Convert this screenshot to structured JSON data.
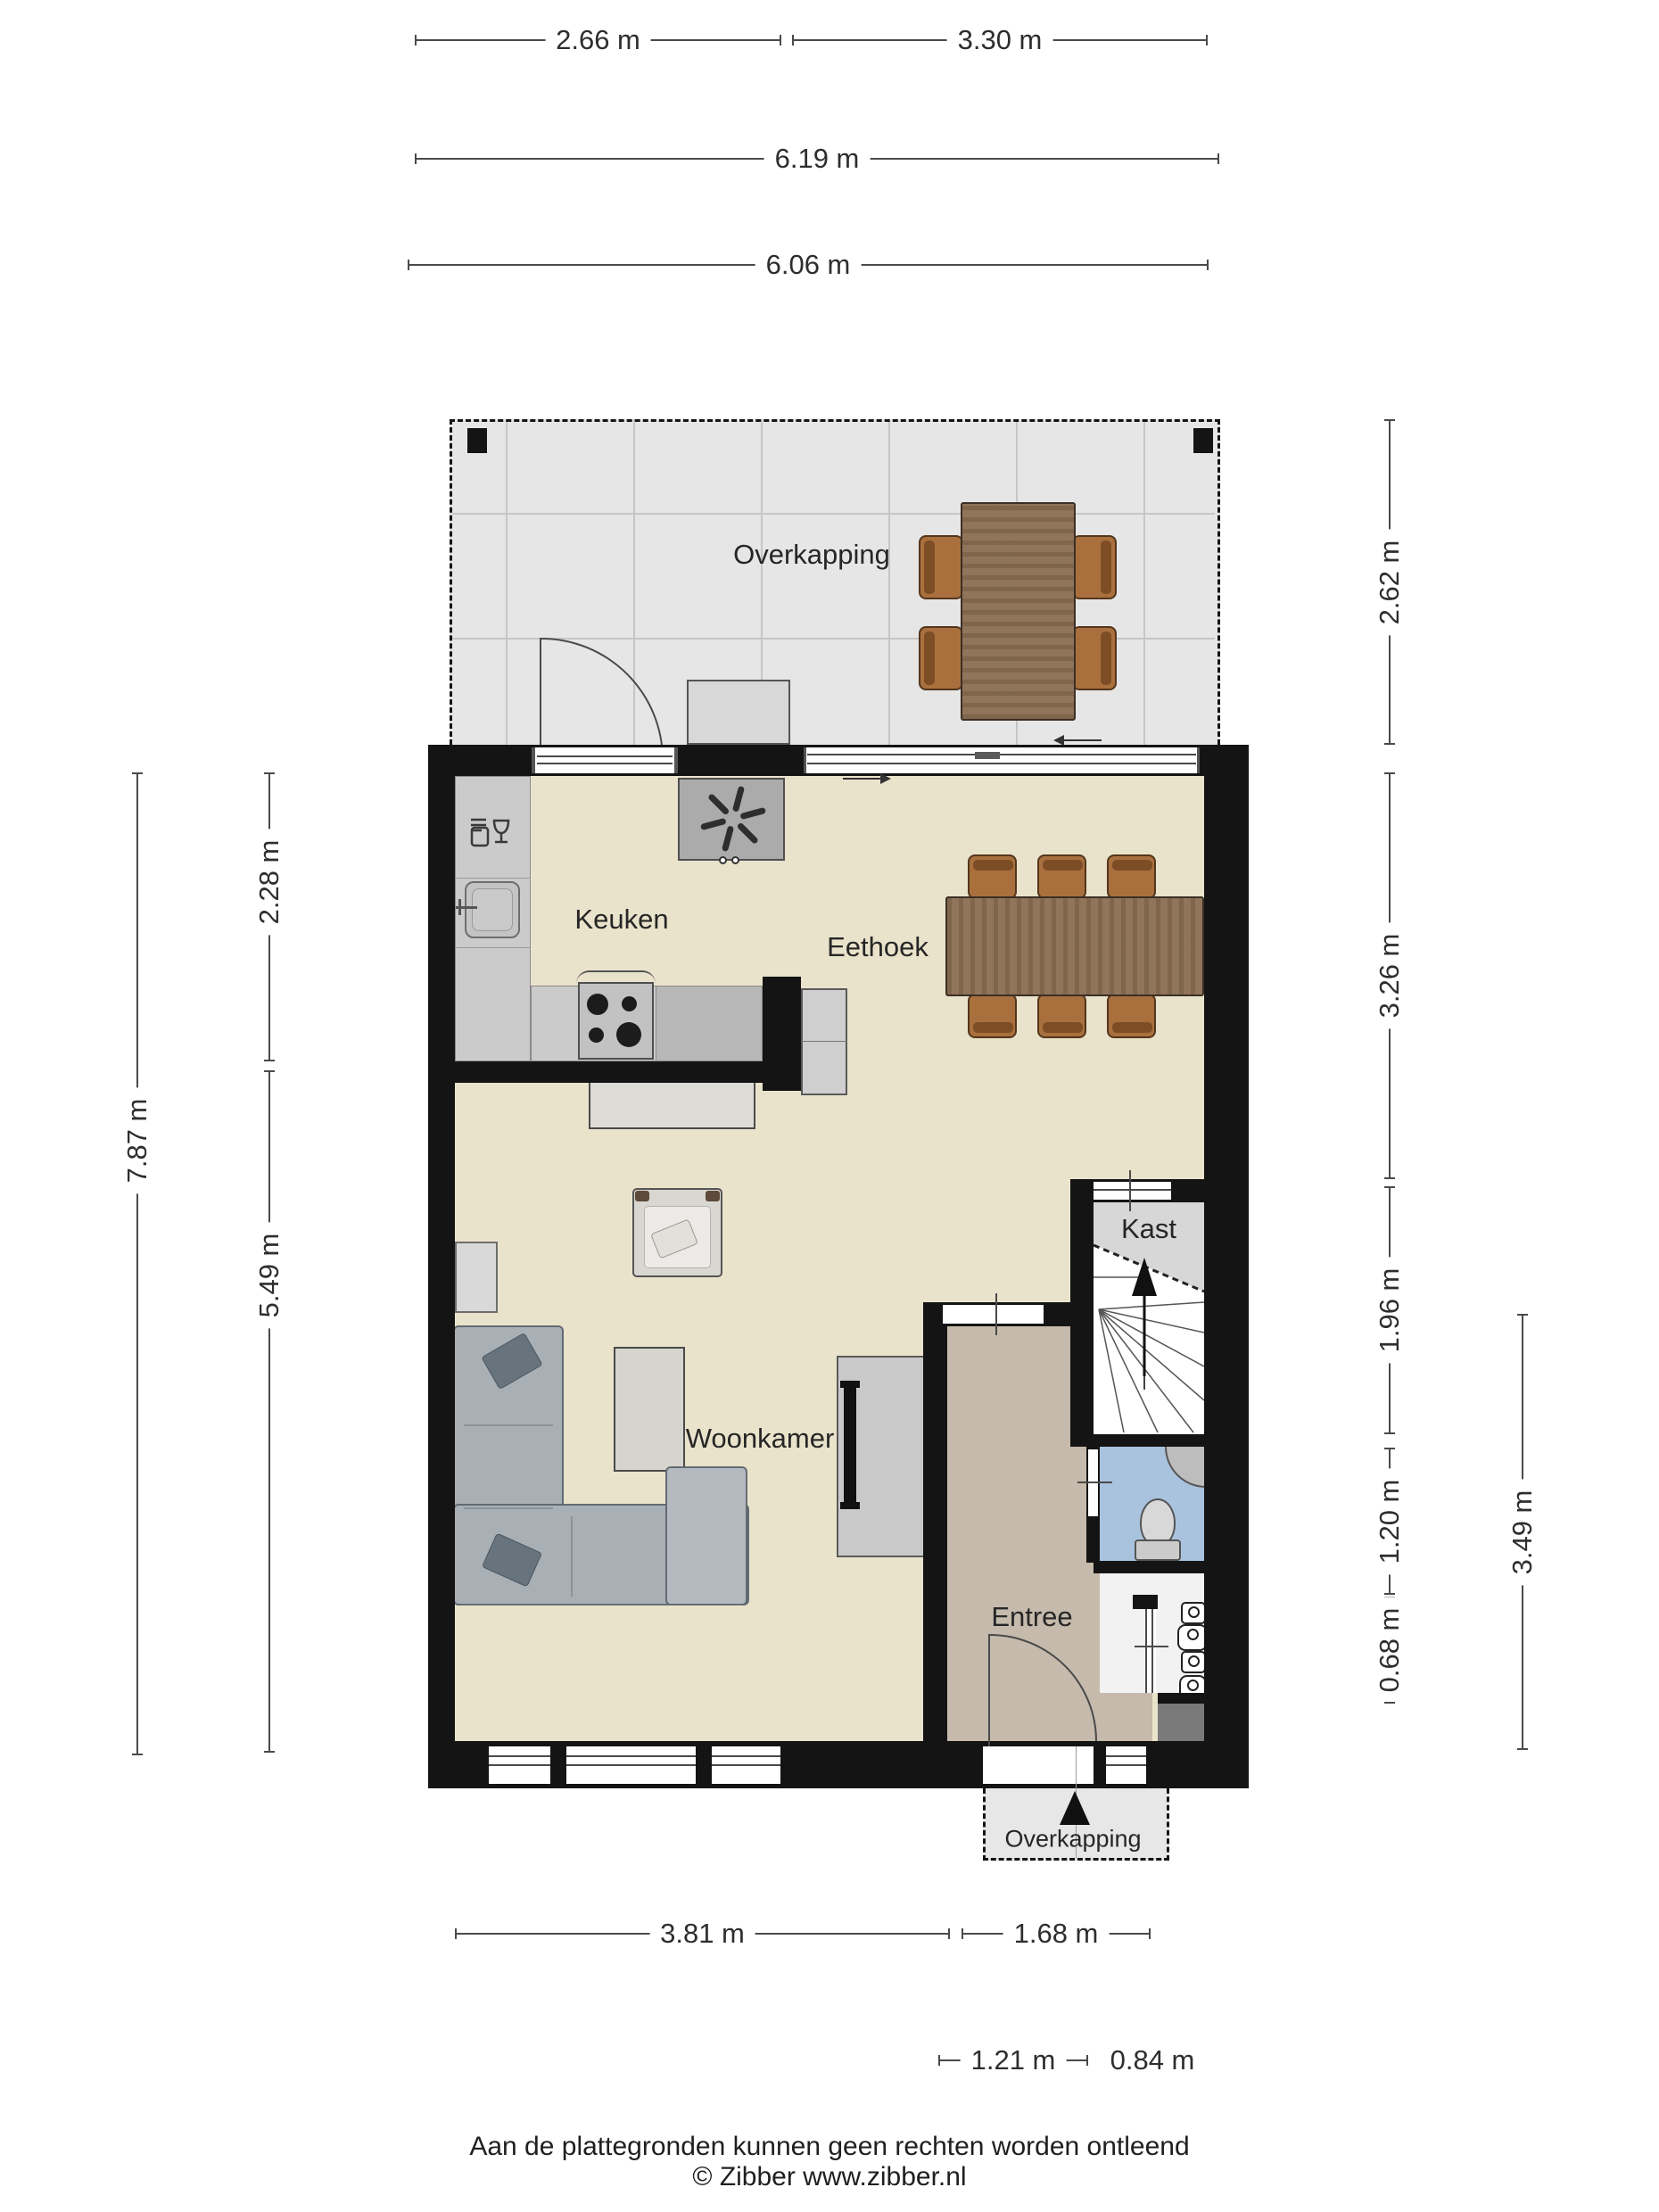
{
  "document": {
    "type": "floor-plan",
    "publisher": "Zibber",
    "language": "nl"
  },
  "rooms": [
    {
      "id": "overkapping-top",
      "label": "Overkapping"
    },
    {
      "id": "keuken",
      "label": "Keuken"
    },
    {
      "id": "eethoek",
      "label": "Eethoek"
    },
    {
      "id": "kast",
      "label": "Kast"
    },
    {
      "id": "woonkamer",
      "label": "Woonkamer"
    },
    {
      "id": "entree",
      "label": "Entree"
    },
    {
      "id": "overkapping-bottom",
      "label": "Overkapping"
    }
  ],
  "dims": [
    {
      "id": "top-overkapping-left",
      "label": "2.66 m"
    },
    {
      "id": "top-overkapping-right",
      "label": "3.30 m"
    },
    {
      "id": "top-overkapping-total",
      "label": "6.19 m"
    },
    {
      "id": "top-house-width",
      "label": "6.06 m"
    },
    {
      "id": "right-overkapping-depth",
      "label": "2.62 m"
    },
    {
      "id": "right-eethoek-depth",
      "label": "3.26 m"
    },
    {
      "id": "right-kast-depth",
      "label": "1.96 m"
    },
    {
      "id": "right-toilet-depth",
      "label": "1.20 m"
    },
    {
      "id": "right-meterkast-depth",
      "label": "0.68 m"
    },
    {
      "id": "right-entree-depth",
      "label": "3.49 m"
    },
    {
      "id": "left-house-depth",
      "label": "7.87 m"
    },
    {
      "id": "left-keuken-depth",
      "label": "2.28 m"
    },
    {
      "id": "left-woonkamer-depth",
      "label": "5.49 m"
    },
    {
      "id": "bottom-woonkamer-width",
      "label": "3.81 m"
    },
    {
      "id": "bottom-entree-width",
      "label": "1.68 m"
    },
    {
      "id": "bottom-porch-width",
      "label": "1.21 m"
    },
    {
      "id": "bottom-porch-side",
      "label": "0.84 m"
    }
  ],
  "footer": {
    "line1": "Aan de plattegronden kunnen geen rechten worden ontleend",
    "line2": "© Zibber www.zibber.nl"
  },
  "icons": {
    "extractor-fan-icon": "pinwheel fan blades",
    "dishwasher-icon": "fork and wine glass",
    "stairs-up-arrow-icon": "▲",
    "entrance-arrow-icon": "▲",
    "sliding-door-arrow-icon": "→ / ←",
    "faucet-icon": "tap on sink",
    "toilet-icon": "wc bowl with cistern",
    "corner-basin-icon": "quarter round basin",
    "power-socket-icon": "meter cupboard sockets"
  },
  "colors": {
    "wall": "#141414",
    "floor_main": "#eae3cb",
    "floor_entree": "#c5baab",
    "floor_toilet": "#a9c3de",
    "patio": "#e6e6e6",
    "wood": "#8a6e52",
    "chair": "#a9703e",
    "sofa": "#a9b0b5",
    "dimension_line": "#4a4a4a"
  }
}
